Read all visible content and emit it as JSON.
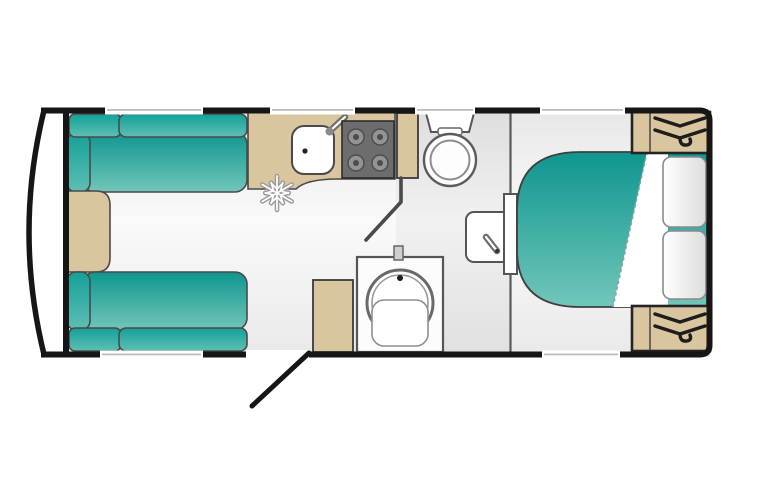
{
  "meta": {
    "title": "Caravan floor plan",
    "view": "top-down layout diagram",
    "text_labels": []
  },
  "colors": {
    "wall": "#161616",
    "outline": "#4a4a4a",
    "teal_dark": "#0f9a92",
    "teal_light": "#70c5b8",
    "wood_tan": "#dac69e",
    "floor_light": "#f8f8f8",
    "floor_shade": "#e9e9e9",
    "hob_dark": "#6d6d6d",
    "hob_burner": "#939393",
    "white_fixture": "#ffffff",
    "pillow_gray": "#e2e2e2",
    "hanger_black": "#1d1d1d",
    "snowflake_gray": "#9b9b9b"
  },
  "rooms": {
    "front_lounge": {
      "name": "front lounge",
      "furniture": [
        "sofa-front-top",
        "sofa-front-bottom",
        "front-chest"
      ],
      "upholstery_color": "teal"
    },
    "kitchen": {
      "name": "kitchen",
      "furniture": [
        "worktop",
        "sink",
        "hob"
      ],
      "hob_burner_count": 4,
      "icons": [
        "snowflake-icon (fridge)",
        "tap-icon"
      ]
    },
    "washroom": {
      "name": "washroom",
      "furniture": [
        "toilet",
        "tall-cupboard",
        "vanity-basin",
        "shower-cubicle",
        "side-cabinet"
      ],
      "icons": [
        "tap-icon",
        "shower-mixer"
      ]
    },
    "bedroom": {
      "name": "rear bedroom",
      "furniture": [
        "island-bed",
        "wardrobe-top",
        "wardrobe-bottom"
      ],
      "pillow_count": 2,
      "icons": [
        "hanger-icon",
        "hanger-icon"
      ],
      "bedding_color": "teal with white turned-down sheet"
    }
  },
  "openings": {
    "top_wall_windows": 4,
    "bottom_wall_windows": 2,
    "entry_door": "bottom wall, shown open at 45 degrees",
    "interior_doors": [
      "washroom door (angled)",
      "bedroom sliding door panel"
    ]
  },
  "counts": {
    "sofas": 2,
    "wardrobes": 2,
    "hanger_icons": 2,
    "burners": 4,
    "pillows": 2,
    "windows": 6
  }
}
